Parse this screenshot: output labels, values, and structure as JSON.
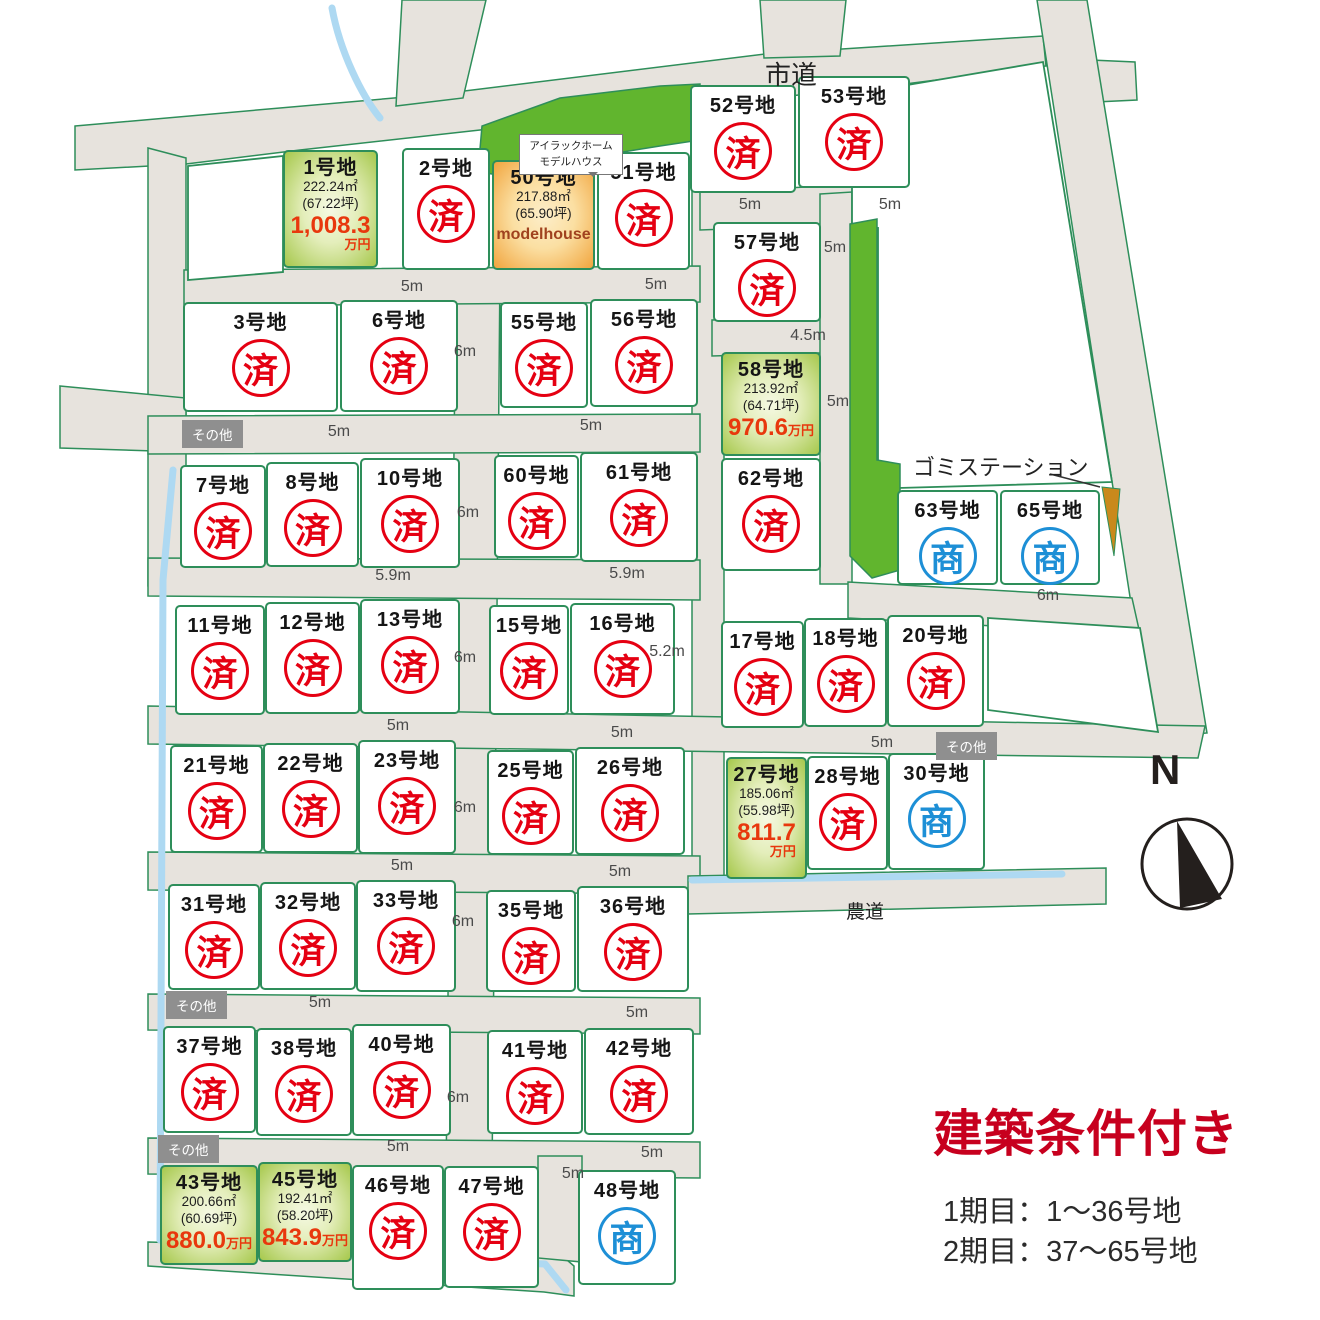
{
  "map": {
    "city_road": "市道",
    "farm_road": "農道",
    "garbage_station": "ゴミステーション",
    "compass_n": "N",
    "tooltip": {
      "line1": "アイラックホーム",
      "line2": "モデルハウス"
    }
  },
  "marks": {
    "sold": "済",
    "commercial": "商"
  },
  "legend": {
    "title": "建築条件付き",
    "phase1": "1期目：1〜36号地",
    "phase2": "2期目：37〜65号地"
  },
  "colors": {
    "accent_red": "#e50012",
    "commercial_blue": "#1d8fd6",
    "price_red": "#e8380d",
    "legend_red": "#c7001e",
    "road_gray": "#e7e3dd",
    "border_green": "#2e8e5a",
    "park_green": "#61b52e",
    "stream_blue": "#aed9f2",
    "station_brown": "#c9891c"
  },
  "lots": [
    {
      "id": "1",
      "label": "1号地",
      "status": "sale",
      "area": "222.24㎡",
      "tsubo": "(67.22坪)",
      "price": "1,008.3",
      "unit": "万円"
    },
    {
      "id": "2",
      "label": "2号地",
      "status": "sold"
    },
    {
      "id": "50",
      "label": "50号地",
      "status": "model",
      "area": "217.88㎡",
      "tsubo": "(65.90坪)",
      "note": "modelhouse"
    },
    {
      "id": "51",
      "label": "51号地",
      "status": "sold"
    },
    {
      "id": "52",
      "label": "52号地",
      "status": "sold"
    },
    {
      "id": "53",
      "label": "53号地",
      "status": "sold"
    },
    {
      "id": "57",
      "label": "57号地",
      "status": "sold"
    },
    {
      "id": "3",
      "label": "3号地",
      "status": "sold"
    },
    {
      "id": "6",
      "label": "6号地",
      "status": "sold"
    },
    {
      "id": "55",
      "label": "55号地",
      "status": "sold"
    },
    {
      "id": "56",
      "label": "56号地",
      "status": "sold"
    },
    {
      "id": "58",
      "label": "58号地",
      "status": "sale",
      "area": "213.92㎡",
      "tsubo": "(64.71坪)",
      "price": "970.6",
      "unit": "万円"
    },
    {
      "id": "62",
      "label": "62号地",
      "status": "sold"
    },
    {
      "id": "63",
      "label": "63号地",
      "status": "commercial"
    },
    {
      "id": "65",
      "label": "65号地",
      "status": "commercial"
    },
    {
      "id": "7",
      "label": "7号地",
      "status": "sold"
    },
    {
      "id": "8",
      "label": "8号地",
      "status": "sold"
    },
    {
      "id": "10",
      "label": "10号地",
      "status": "sold"
    },
    {
      "id": "60",
      "label": "60号地",
      "status": "sold"
    },
    {
      "id": "61",
      "label": "61号地",
      "status": "sold"
    },
    {
      "id": "11",
      "label": "11号地",
      "status": "sold"
    },
    {
      "id": "12",
      "label": "12号地",
      "status": "sold"
    },
    {
      "id": "13",
      "label": "13号地",
      "status": "sold"
    },
    {
      "id": "15",
      "label": "15号地",
      "status": "sold"
    },
    {
      "id": "16",
      "label": "16号地",
      "status": "sold"
    },
    {
      "id": "17",
      "label": "17号地",
      "status": "sold"
    },
    {
      "id": "18",
      "label": "18号地",
      "status": "sold"
    },
    {
      "id": "20",
      "label": "20号地",
      "status": "sold"
    },
    {
      "id": "21",
      "label": "21号地",
      "status": "sold"
    },
    {
      "id": "22",
      "label": "22号地",
      "status": "sold"
    },
    {
      "id": "23",
      "label": "23号地",
      "status": "sold"
    },
    {
      "id": "25",
      "label": "25号地",
      "status": "sold"
    },
    {
      "id": "26",
      "label": "26号地",
      "status": "sold"
    },
    {
      "id": "27",
      "label": "27号地",
      "status": "sale",
      "area": "185.06㎡",
      "tsubo": "(55.98坪)",
      "price": "811.7",
      "unit": "万円"
    },
    {
      "id": "28",
      "label": "28号地",
      "status": "sold"
    },
    {
      "id": "30",
      "label": "30号地",
      "status": "commercial"
    },
    {
      "id": "31",
      "label": "31号地",
      "status": "sold"
    },
    {
      "id": "32",
      "label": "32号地",
      "status": "sold"
    },
    {
      "id": "33",
      "label": "33号地",
      "status": "sold"
    },
    {
      "id": "35",
      "label": "35号地",
      "status": "sold"
    },
    {
      "id": "36",
      "label": "36号地",
      "status": "sold"
    },
    {
      "id": "37",
      "label": "37号地",
      "status": "sold"
    },
    {
      "id": "38",
      "label": "38号地",
      "status": "sold"
    },
    {
      "id": "40",
      "label": "40号地",
      "status": "sold"
    },
    {
      "id": "41",
      "label": "41号地",
      "status": "sold"
    },
    {
      "id": "42",
      "label": "42号地",
      "status": "sold"
    },
    {
      "id": "43",
      "label": "43号地",
      "status": "sale",
      "area": "200.66㎡",
      "tsubo": "(60.69坪)",
      "price": "880.0",
      "unit": "万円"
    },
    {
      "id": "45",
      "label": "45号地",
      "status": "sale",
      "area": "192.41㎡",
      "tsubo": "(58.20坪)",
      "price": "843.9",
      "unit": "万円"
    },
    {
      "id": "46",
      "label": "46号地",
      "status": "sold"
    },
    {
      "id": "47",
      "label": "47号地",
      "status": "sold"
    },
    {
      "id": "48",
      "label": "48号地",
      "status": "commercial"
    }
  ],
  "road_labels": [
    "5m",
    "5m",
    "5m",
    "5m",
    "5m",
    "4.5m",
    "5m",
    "6m",
    "5m",
    "5m",
    "6m",
    "5.9m",
    "5.9m",
    "6m",
    "6m",
    "5.2m",
    "5m",
    "5m",
    "5m",
    "6m",
    "5m",
    "5m",
    "6m",
    "5m",
    "5m",
    "6m",
    "5m",
    "5m",
    "5m"
  ],
  "misc_boxes": [
    "その他",
    "その他",
    "その他",
    "その他"
  ]
}
